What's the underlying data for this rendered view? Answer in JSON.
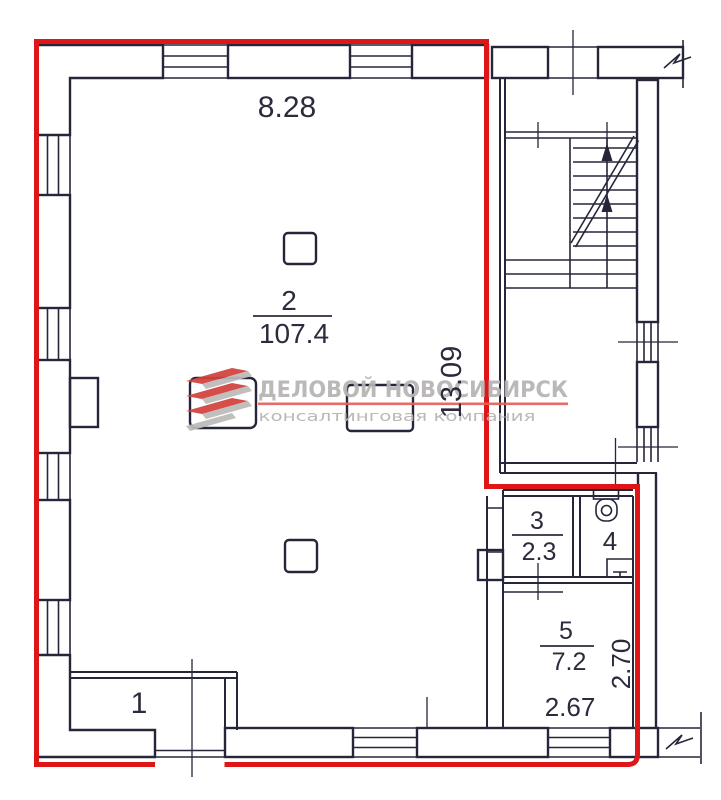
{
  "plan": {
    "background": "#ffffff",
    "line_color": "#26263a",
    "outline_color": "#de1617",
    "rooms": [
      {
        "number": "1",
        "area": ""
      },
      {
        "number": "2",
        "area": "107.4"
      },
      {
        "number": "3",
        "area": "2.3"
      },
      {
        "number": "4",
        "area": ""
      },
      {
        "number": "5",
        "area": "7.2"
      }
    ],
    "dimensions": {
      "top": "8.28",
      "right": "13.09",
      "room5_bottom": "2.67",
      "room5_right": "2.70"
    }
  },
  "watermark": {
    "title": "ДЕЛОВОЙ НОВОСИБИРСК",
    "subtitle": "консалтинговая компания",
    "text_color": "#b6b3b3",
    "underline_color": "#e2625e",
    "logo_red": "#d2413c",
    "logo_gray": "#bdbaba"
  }
}
